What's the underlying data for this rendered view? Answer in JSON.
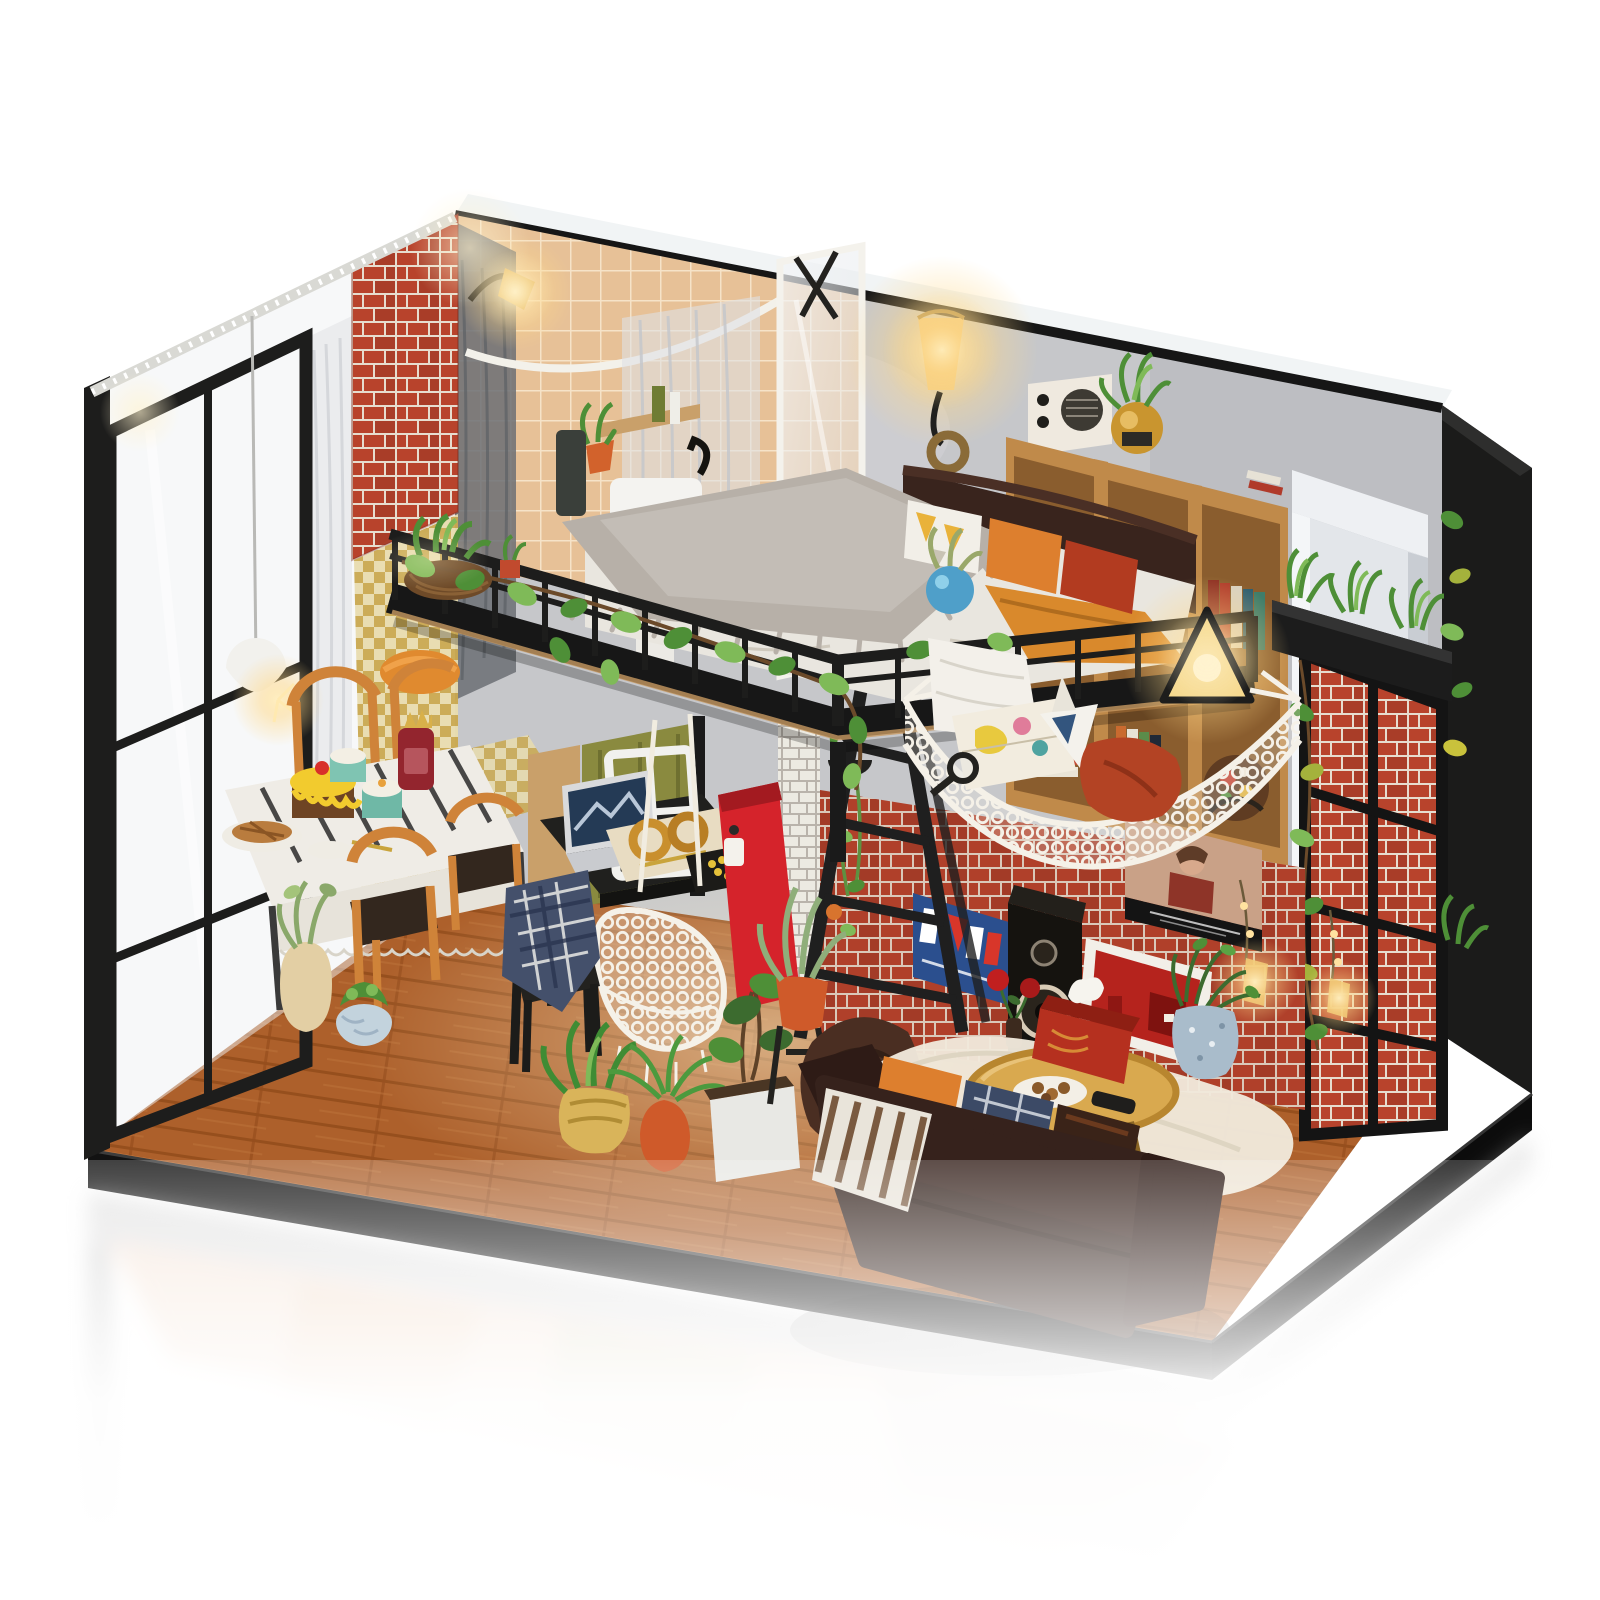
{
  "meta": {
    "image_type": "product-photograph",
    "subject": "diy-miniature-dollhouse-loft-apartment",
    "visible_text": ""
  },
  "palette": {
    "bg": "#ffffff",
    "wallGray": "#c6c7ca",
    "wallGrayDark": "#b2b3b7",
    "brickRed": "#b8432c",
    "brickAlt": "#a93d28",
    "brickMortar": "#e7ddcf",
    "brickWhite": "#eceae2",
    "brickWhiteBg": "#b9b3ab",
    "frameBlack": "#1d1d1c",
    "woodFloor": "#b4662f",
    "woodFloorDark": "#9a521f",
    "shelfWood": "#c08a4a",
    "shelfWoodDark": "#8a5d2e",
    "tileTan": "#e7c197",
    "tileLine": "#f6e3c8",
    "curtainSheer": "#e9eaec",
    "goldChecker": "#caa84f",
    "goldCheckerLight": "#e8dcae",
    "sofaBrown": "#36221c",
    "sofaDark": "#2e1b16",
    "duvetWhite": "#e9e6df",
    "furGray": "#b7b0a8",
    "blanketOrange": "#d9892c",
    "pillowOrange": "#dd7f2e",
    "pillowRed": "#b23b20",
    "plantGreen": "#4e8f37",
    "plantLight": "#7fba58",
    "hammockWhite": "#f3efe6",
    "netWhite": "#f5f1e8",
    "machineRed": "#d5232b",
    "fridgeWhite": "#e3e6ea",
    "rugCream": "#f0e9dc",
    "tableGold": "#d9a94f",
    "tissueRed": "#b5301f",
    "baseBlack": "#121212",
    "chairWood": "#cf8339",
    "doorOlive": "#8a8a3f",
    "laptopScreen": "#243a55",
    "speakerBlack": "#15130f",
    "posterNavy": "#2b4f8e",
    "mintCake": "#7fc4b2",
    "jarRed": "#93252e",
    "stoneBlue": "#a9bccb",
    "vaseBlue": "#4f9fc9",
    "clothWhite": "#efece6",
    "glowWarm": "#ffd98a",
    "ledWhite": "#f5f5f0"
  },
  "scene": {
    "background": "#ffffff",
    "objects": [
      "glass-front-door",
      "led-strip",
      "sheer-curtain",
      "brick-pier",
      "gold-checker-curtain",
      "pendant-lamp",
      "bathroom-tile-wall",
      "shower-rod",
      "shower-curtain",
      "shower-glass-panel",
      "bathroom-sink",
      "bathroom-sconce",
      "loft-bed-platform",
      "loft-railing",
      "vine-garland",
      "bed-headboard",
      "duvet",
      "fur-throw",
      "orange-blanket",
      "pillow-yellow-print",
      "pillow-orange",
      "pillow-red",
      "railing-planter",
      "blue-ball-vase",
      "wall-sconce-amber",
      "radio",
      "gold-plant-pot",
      "cube-bookshelf",
      "books",
      "globe",
      "triangle-lamp",
      "fridge-cabinet",
      "right-window-lattice",
      "right-planter-box",
      "string-lights",
      "brick-feature-wall",
      "love-poster",
      "photo-poster",
      "speaker",
      "red-art-frame",
      "rose-vase",
      "step-ladder",
      "white-brick-pillar",
      "hanging-plant-basket",
      "net-hammock",
      "hammock-pillow",
      "world-map",
      "origami-boat",
      "magnifier",
      "red-cushion",
      "dining-table",
      "yellow-cake",
      "mint-cakes",
      "red-jar",
      "pie-plate",
      "wood-chairs",
      "plaid-chair",
      "work-desk",
      "laptop",
      "white-window-frame-decor",
      "pretzels",
      "snack-tray",
      "coffee-machine",
      "hanging-crochet-chair",
      "potted-plants",
      "bean-bag",
      "fur-rug",
      "round-coffee-table",
      "cookie-plate",
      "remote",
      "tissue-box",
      "leather-sofa",
      "sofa-pillows",
      "striped-blanket",
      "stone-vase-plant",
      "black-base",
      "floor-reflection"
    ]
  }
}
